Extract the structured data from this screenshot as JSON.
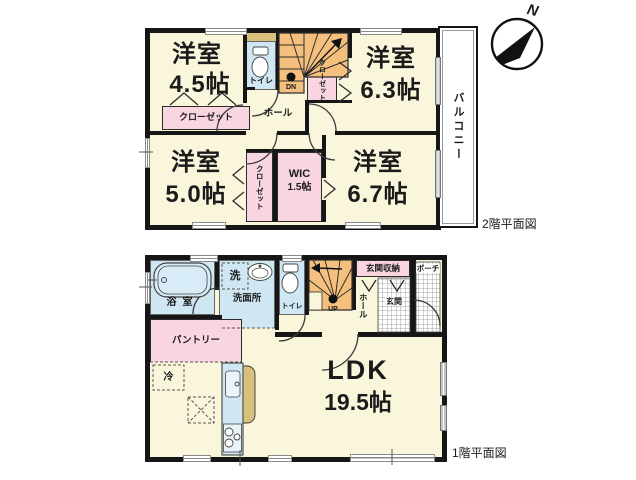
{
  "compass": {
    "north": "N"
  },
  "floor2": {
    "caption": "2階平面図",
    "room45": {
      "name": "洋室",
      "size": "4.5帖"
    },
    "room63": {
      "name": "洋室",
      "size": "6.3帖"
    },
    "room50": {
      "name": "洋室",
      "size": "5.0帖"
    },
    "room67": {
      "name": "洋室",
      "size": "6.7帖"
    },
    "wic": {
      "name": "WIC",
      "size": "1.5帖"
    },
    "labels": {
      "toilet": "トイレ",
      "closet_a": "クローゼット",
      "closet_b": "クローゼット",
      "closet_c": "クローゼット",
      "hall": "ホール",
      "down": "DN",
      "balcony": "バルコニー"
    }
  },
  "floor1": {
    "caption": "1階平面図",
    "ldk": {
      "name": "LDK",
      "size": "19.5帖"
    },
    "labels": {
      "bath": "浴室",
      "washer": "洗",
      "washroom": "洗面所",
      "toilet": "トイレ",
      "up": "UP",
      "entry_storage": "玄関収納",
      "hall": "ホール",
      "entry": "玄関",
      "porch": "ポーチ",
      "pantry": "パントリー",
      "fridge": "冷"
    }
  }
}
